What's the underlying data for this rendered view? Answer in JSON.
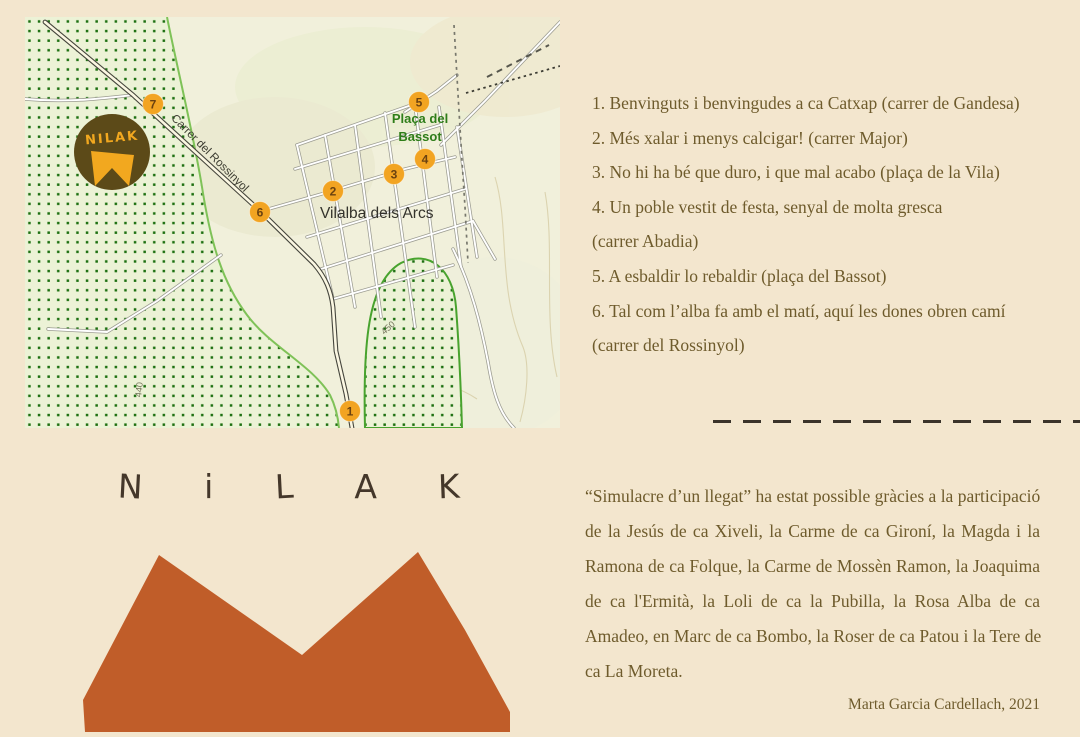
{
  "colors": {
    "page_bg": "#f3e6ce",
    "map_bg": "#f1f0db",
    "dotted_area_bg": "#ecf2d6",
    "dot_green": "#1d7011",
    "boundary_green": "#7fc258",
    "marker_orange": "#f2a422",
    "marker_number_brown": "#6b4210",
    "logo_circle_brown": "#5c4a18",
    "logo_yellow": "#f2a81f",
    "mountain_orange": "#c05d29",
    "legend_text": "#6e5b2c",
    "wordmark_text": "#44372a",
    "town_label": "#33322b",
    "placa_label_green": "#2e7d19"
  },
  "map": {
    "town_label": "Vilalba dels Arcs",
    "placa_label_line1": "Plaça del",
    "placa_label_line2": "Bassot",
    "street_label": "Carrer del Rossinyol",
    "contour_label_450": "450",
    "contour_label_440": "440",
    "logo_text": "NILAK",
    "markers": [
      "1",
      "2",
      "3",
      "4",
      "5",
      "6",
      "7"
    ]
  },
  "wordmark": {
    "letters": [
      "N",
      "i",
      "L",
      "A",
      "K"
    ]
  },
  "legend": {
    "lines": [
      "1. Benvinguts i benvingudes a ca Catxap (carrer de Gandesa)",
      "2. Més xalar i menys calcigar! (carrer Major)",
      "3. No hi ha bé que duro, i que mal acabo (plaça de la Vila)",
      "4. Un poble vestit de festa, senyal de molta gresca",
      "(carrer Abadia)",
      "5. A esbaldir lo rebaldir (plaça del Bassot)",
      "6. Tal com l’alba fa amb el matí, aquí les dones obren camí",
      "(carrer del Rossinyol)"
    ]
  },
  "credits": {
    "lines": [
      "“Simulacre d’un llegat” ha estat possible gràcies a la participació",
      "de la Jesús de ca Xiveli, la Carme de ca Gironí, la Magda i la",
      "Ramona de ca Folque, la Carme de Mossèn Ramon, la Joaquima",
      "de ca l'Ermità, la Loli de ca la Pubilla, la Rosa Alba de ca",
      "Amadeo, en Marc de ca Bombo, la Roser de ca Patou i la Tere de",
      "ca La Moreta."
    ],
    "author": "Marta Garcia Cardellach, 2021"
  }
}
